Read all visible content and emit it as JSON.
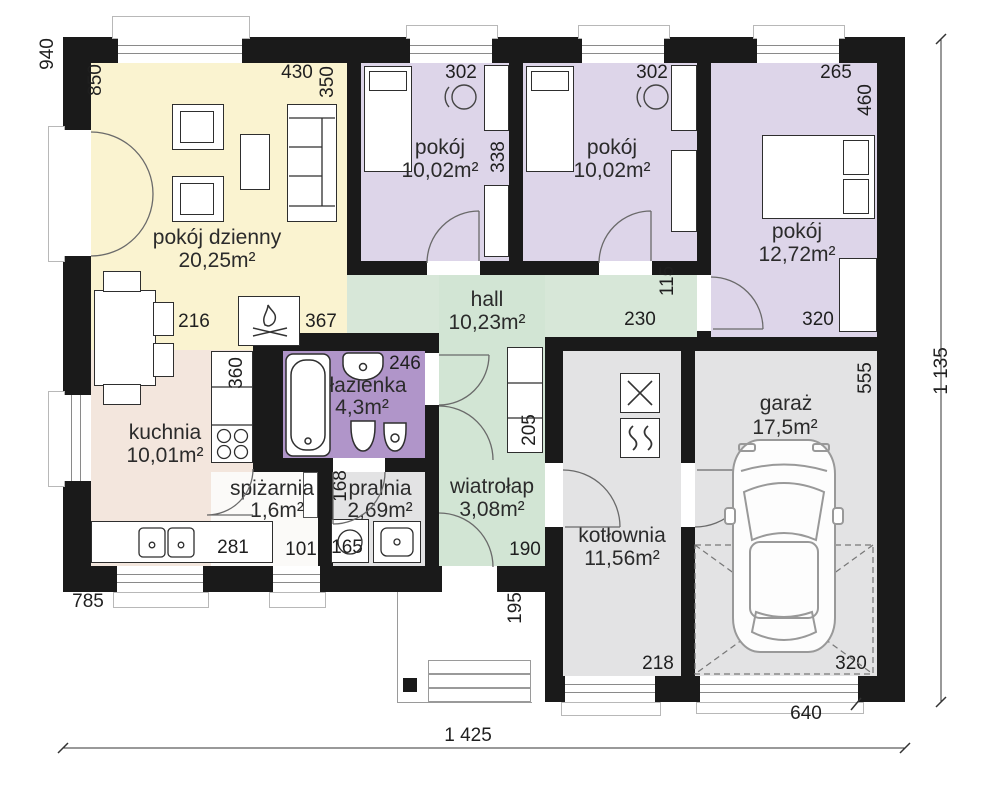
{
  "palette": {
    "wall": "#1a1a1a",
    "living": "#faf3d0",
    "bedroom": "#ddd5e9",
    "bathroom": "#b095c9",
    "hall": "#d7e7d8",
    "vestibule": "#d2e5d4",
    "kitchen": "#f3e6dd",
    "pantry": "#fbfaf8",
    "utility_gray": "#e3e3e4"
  },
  "rooms": {
    "living": {
      "label": "pokój dzienny",
      "area": "20,25m²"
    },
    "bed1": {
      "label": "pokój",
      "area": "10,02m²"
    },
    "bed2": {
      "label": "pokój",
      "area": "10,02m²"
    },
    "bed3": {
      "label": "pokój",
      "area": "12,72m²"
    },
    "kitchen": {
      "label": "kuchnia",
      "area": "10,01m²"
    },
    "hall": {
      "label": "hall",
      "area": "10,23m²"
    },
    "bath": {
      "label": "łazienka",
      "area": "4,3m²"
    },
    "pantry": {
      "label": "spiżarnia",
      "area": "1,6m²"
    },
    "laundry": {
      "label": "pralnia",
      "area": "2,69m²"
    },
    "vestibule": {
      "label": "wiatrołap",
      "area": "3,08m²"
    },
    "boiler": {
      "label": "kotłownia",
      "area": "11,56m²"
    },
    "garage": {
      "label": "garaż",
      "area": "17,5m²"
    }
  },
  "dims": {
    "overall_width": "1 425",
    "overall_height": "1 135",
    "top_left_940": "940",
    "living_door_850": "850",
    "living_430": "430",
    "living_350": "350",
    "bed1_302": "302",
    "bed2_302": "302",
    "bed3_265": "265",
    "bed3_460": "460",
    "bed3_320": "320",
    "wardrobe_338": "338",
    "hall_115": "115",
    "hall_230": "230",
    "table_216": "216",
    "fireplace_367": "367",
    "kitchen_360": "360",
    "bath_246": "246",
    "tub_180": "180",
    "closet_205": "205",
    "laundry_168": "168",
    "kitchen_281": "281",
    "pantry_101": "101",
    "washer_165": "165",
    "vestibule_190": "190",
    "porch_195": "195",
    "boiler_218": "218",
    "garage_320": "320",
    "garage_555": "555",
    "left_785": "785",
    "bottom_640": "640"
  }
}
